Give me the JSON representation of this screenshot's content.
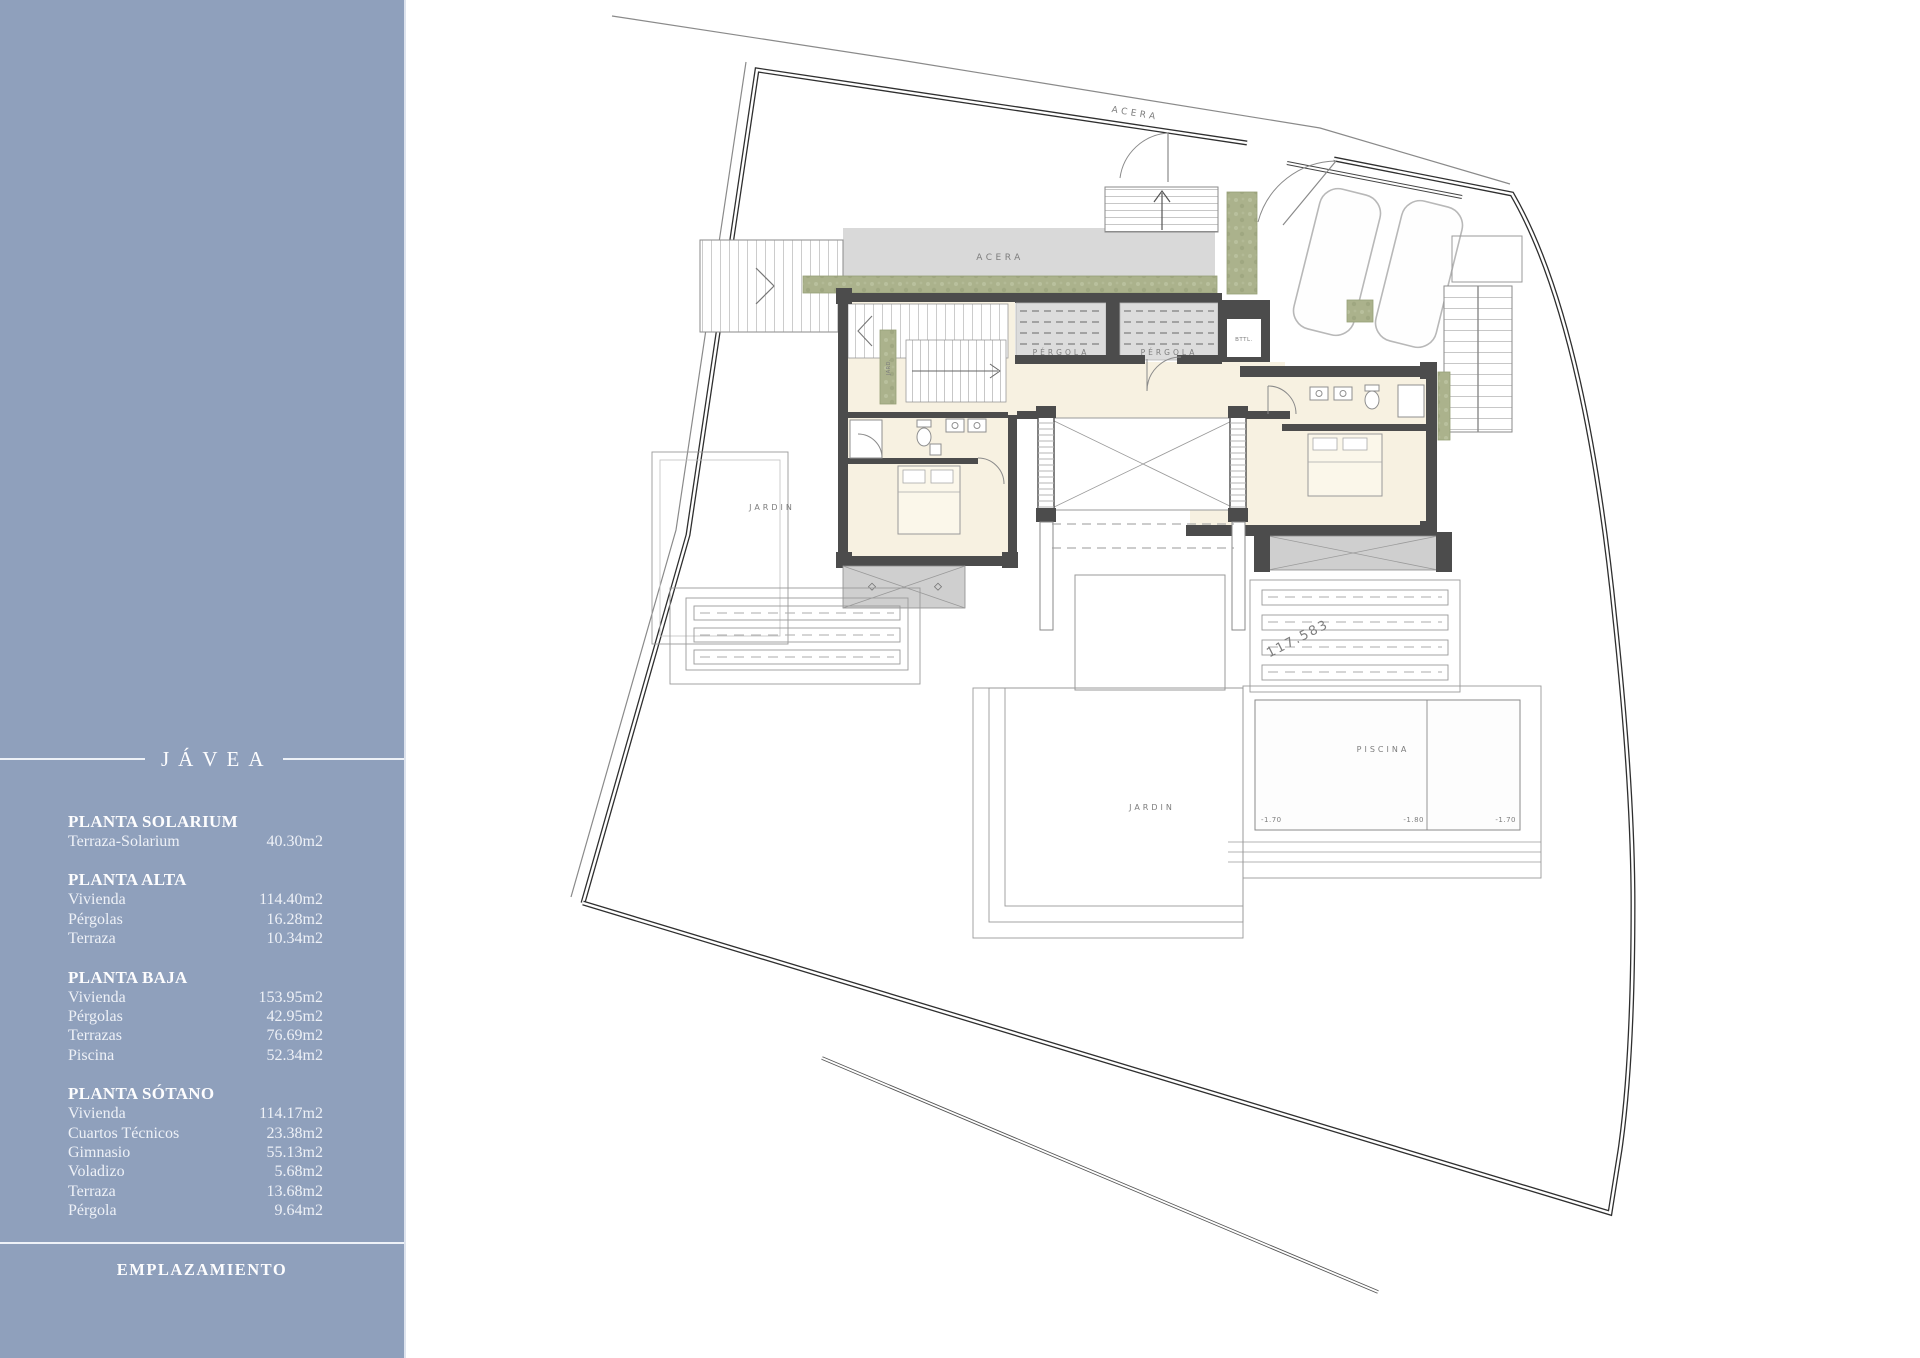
{
  "colors": {
    "sidebar_bg": "#8fa0bc",
    "plan_cream": "#f7f1e1",
    "plan_green": "#abb28c",
    "wall_dark": "#4c4c4c",
    "walk_gray": "#d9d9d9"
  },
  "sidebar": {
    "title": "JÁVEA",
    "footer": "EMPLAZAMIENTO",
    "sections": [
      {
        "heading": "PLANTA SOLARIUM",
        "rows": [
          {
            "label": "Terraza-Solarium",
            "value": "40.30m2"
          }
        ]
      },
      {
        "heading": "PLANTA ALTA",
        "rows": [
          {
            "label": "Vivienda",
            "value": "114.40m2"
          },
          {
            "label": "Pérgolas",
            "value": "16.28m2"
          },
          {
            "label": "Terraza",
            "value": "10.34m2"
          }
        ]
      },
      {
        "heading": "PLANTA BAJA",
        "rows": [
          {
            "label": "Vivienda",
            "value": "153.95m2"
          },
          {
            "label": "Pérgolas",
            "value": "42.95m2"
          },
          {
            "label": "Terrazas",
            "value": "76.69m2"
          },
          {
            "label": "Piscina",
            "value": "52.34m2"
          }
        ]
      },
      {
        "heading": "PLANTA SÓTANO",
        "rows": [
          {
            "label": "Vivienda",
            "value": "114.17m2"
          },
          {
            "label": "Cuartos Técnicos",
            "value": "23.38m2"
          },
          {
            "label": "Gimnasio",
            "value": "55.13m2"
          },
          {
            "label": "Voladizo",
            "value": "5.68m2"
          },
          {
            "label": "Terraza",
            "value": "13.68m2"
          },
          {
            "label": "Pérgola",
            "value": "9.64m2"
          }
        ]
      }
    ]
  },
  "plan": {
    "labels": {
      "acera_street": "ACERA",
      "acera_walk": "ACERA",
      "pergola_left": "PÉRGOLA",
      "pergola_right": "PÉRGOLA",
      "jard_strip": "JARD.",
      "util_room": "BTTL.",
      "jardin_west": "JARDIN",
      "jardin_south": "JARDIN",
      "piscina": "PISCINA",
      "pool_level_left": "-1.70",
      "pool_level_mid": "-1.80",
      "pool_level_right": "-1.70",
      "survey_mark": "117.583"
    }
  }
}
